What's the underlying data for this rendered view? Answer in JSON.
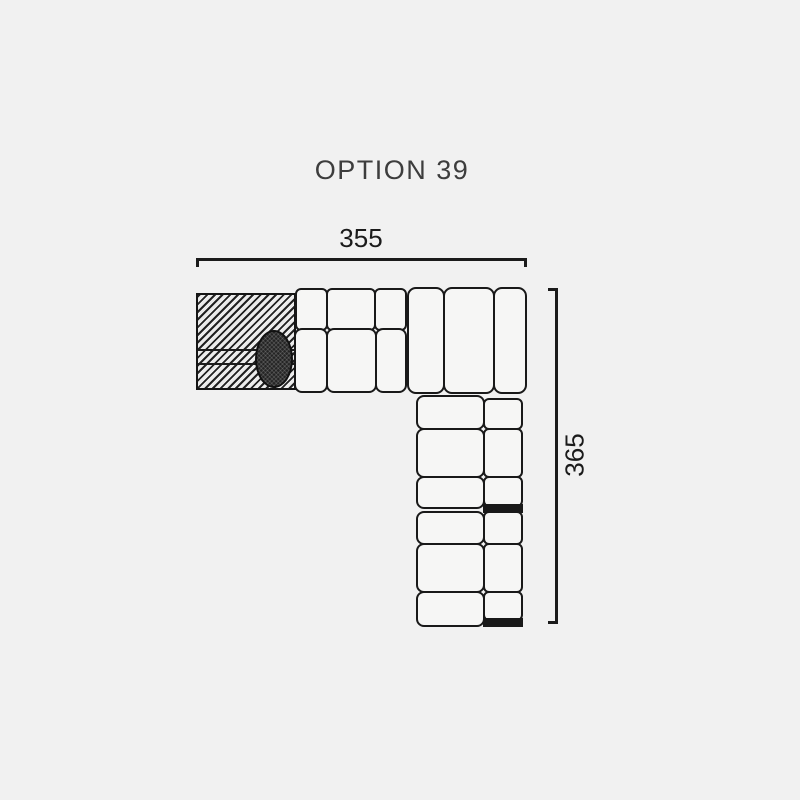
{
  "header": {
    "title": "OPTION 39"
  },
  "diagram": {
    "type": "sectional-sofa-top-view",
    "dimensions": {
      "width": {
        "value": "355"
      },
      "height": {
        "value": "365"
      }
    },
    "colors": {
      "background": "#f1f1f1",
      "line": "#191919",
      "cushion_fill": "#f6f6f5",
      "title_text": "#3d3d3d",
      "dimension_text": "#1b1b1b",
      "hatch_dark": "#222222",
      "oval_fill": "#242424"
    },
    "modules": {
      "horizontal_row": [
        "hatched-platform-with-oval-cushion",
        "three-seat-module-with-backrest",
        "corner-bench-three-tall-cushions"
      ],
      "vertical_column": [
        "three-seat-module-with-backrest",
        "three-seat-module-with-backrest"
      ]
    }
  }
}
